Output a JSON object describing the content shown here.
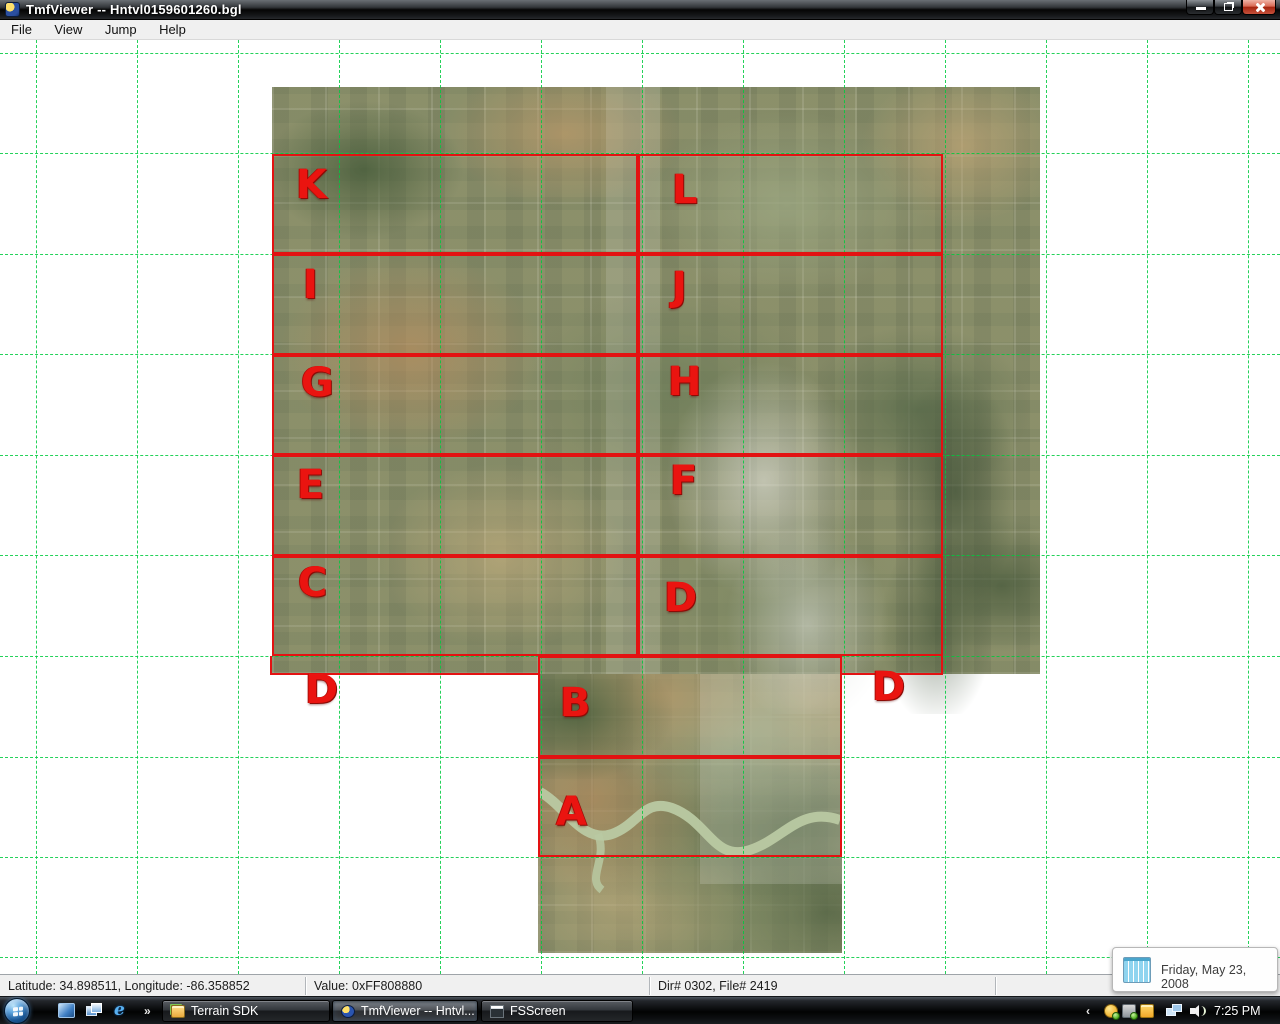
{
  "window": {
    "title": "TmfViewer -- Hntvl0159601260.bgl"
  },
  "menu": {
    "items": [
      "File",
      "View",
      "Jump",
      "Help"
    ]
  },
  "map": {
    "labels": [
      {
        "id": "K",
        "text": "K"
      },
      {
        "id": "L",
        "text": "L"
      },
      {
        "id": "I",
        "text": "I"
      },
      {
        "id": "J",
        "text": "J"
      },
      {
        "id": "G",
        "text": "G"
      },
      {
        "id": "H",
        "text": "H"
      },
      {
        "id": "E",
        "text": "E"
      },
      {
        "id": "F",
        "text": "F"
      },
      {
        "id": "C",
        "text": "C"
      },
      {
        "id": "D-box",
        "text": "D"
      },
      {
        "id": "D-left",
        "text": "D"
      },
      {
        "id": "D-right",
        "text": "D"
      },
      {
        "id": "B",
        "text": "B"
      },
      {
        "id": "A",
        "text": "A"
      }
    ]
  },
  "status_bar": {
    "position": "Latitude: 34.898511, Longitude: -86.358852",
    "value": "Value: 0xFF808880",
    "dir_file": "Dir# 0302, File# 2419"
  },
  "taskbar": {
    "overflow_chevron": "»",
    "tray_chevron": "‹",
    "buttons": [
      {
        "label": "Terrain SDK"
      },
      {
        "label": "TmfViewer -- Hntvl..."
      },
      {
        "label": "FSScreen"
      }
    ],
    "clock": "7:25 PM"
  },
  "date_tooltip": {
    "text": "Friday, May 23, 2008"
  },
  "colors": {
    "region_box_red": "#e31212",
    "region_letter_red": "#ea1410",
    "lod_grid_green": "#00cb3e"
  }
}
